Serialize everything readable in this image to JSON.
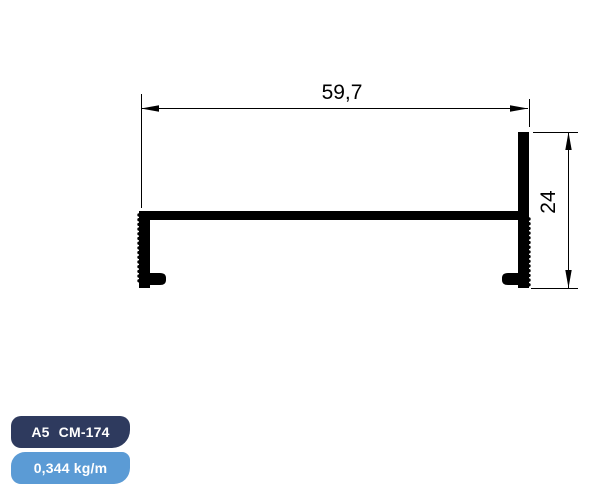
{
  "figure": {
    "dimensions": {
      "width_label": "59,7",
      "height_label": "24"
    }
  },
  "badges": {
    "part_series": "A5",
    "part_code": "CM-174",
    "weight": "0,344 kg/m"
  },
  "colors": {
    "ink": "#000000",
    "navy": "#2e3a5e",
    "blue": "#5b9bd5",
    "bg": "#ffffff"
  }
}
